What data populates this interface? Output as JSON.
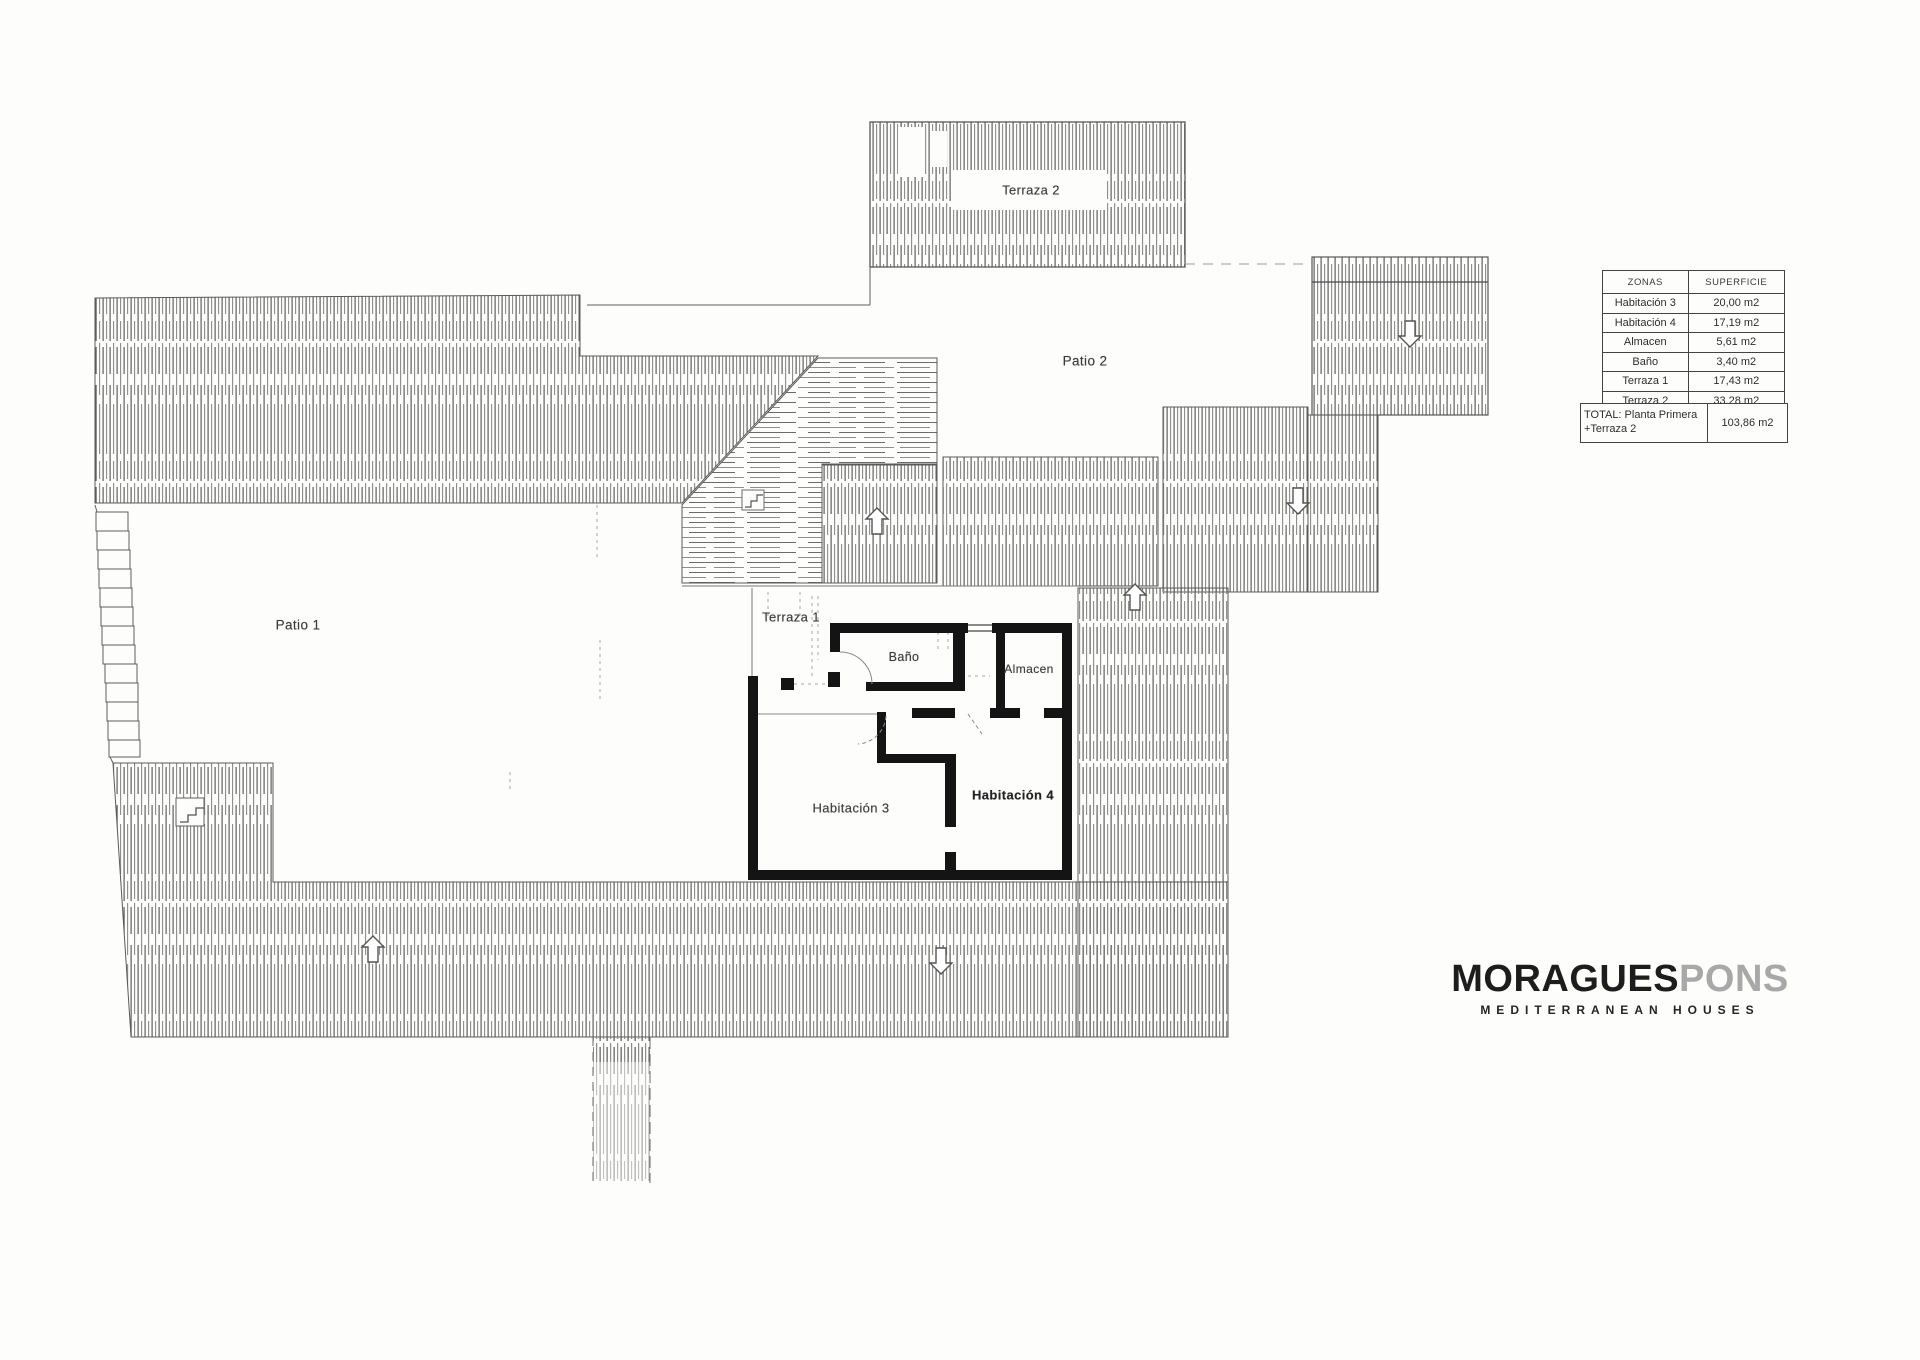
{
  "document": {
    "kind": "first floor plan drawing"
  },
  "plan": {
    "labels": {
      "terraza2": "Terraza 2",
      "patio2": "Patio 2",
      "patio1": "Patio 1",
      "terraza1": "Terraza 1",
      "bano": "Baño",
      "almacen": "Almacen",
      "habitacion3": "Habitación 3",
      "habitacion4": "Habitación 4"
    }
  },
  "areas_table": {
    "headers": {
      "zone": "ZONAS",
      "area": "SUPERFICIE"
    },
    "rows": [
      {
        "zone": "Habitación 3",
        "area": "20,00 m2"
      },
      {
        "zone": "Habitación 4",
        "area": "17,19 m2"
      },
      {
        "zone": "Almacen",
        "area": "5,61 m2"
      },
      {
        "zone": "Baño",
        "area": "3,40 m2"
      },
      {
        "zone": "Terraza 1",
        "area": "17,43 m2"
      },
      {
        "zone": "Terraza 2",
        "area": "33,28 m2"
      }
    ],
    "total": {
      "zone": "TOTAL: Planta Primera +Terraza 2",
      "area": "103,86 m2"
    }
  },
  "branding": {
    "name_primary": "MORAGUES",
    "name_secondary": "PONS",
    "tagline": "MEDITERRANEAN HOUSES"
  },
  "colors": {
    "paper": "#fdfdfc",
    "line": "#5a5a5a",
    "hatch": "#777777",
    "wall": "#141414",
    "logo_primary": "#1d1d1d",
    "logo_secondary": "#a8a8a8"
  }
}
